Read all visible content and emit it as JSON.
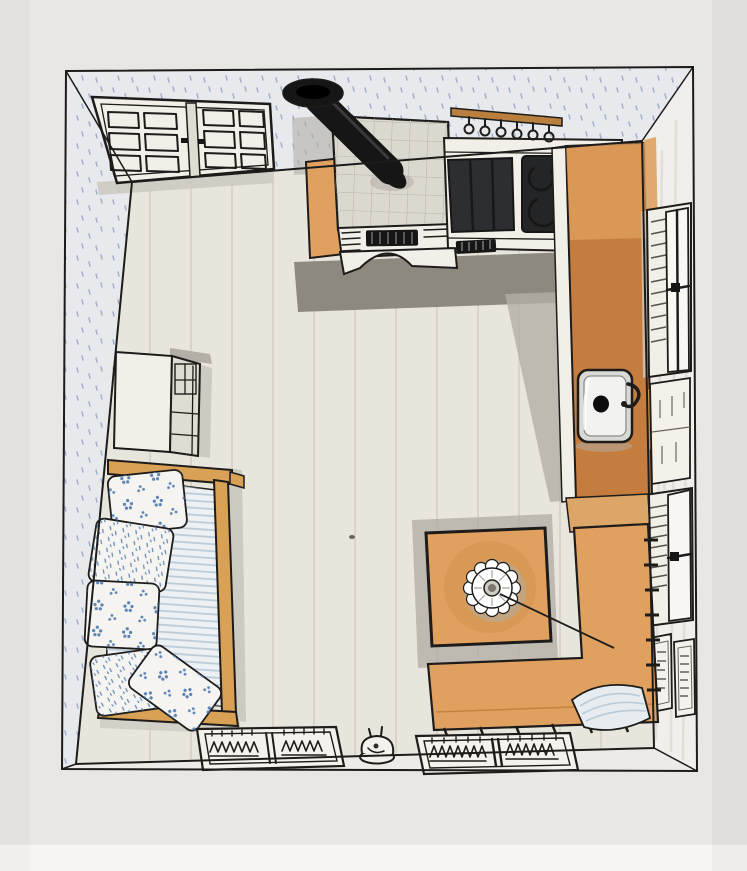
{
  "meta": {
    "title": "Hand-drawn marker sketch: bird's-eye floor plan of a farmhouse kitchen",
    "view": "top-down perspective, walls splayed outward, no visible text"
  },
  "palette": {
    "paper": "#e9e7e4",
    "paper_edge": "#f6f5f2",
    "ink": "#1d1c1a",
    "wall": "#e7e9ec",
    "wall_right": "#f0efeb",
    "wall_bottom": "#edebe7",
    "speckle": "#7189b4",
    "floor": "#e8e5dd",
    "plank": "#d5d0c3",
    "shadow_dark": "#8e897f",
    "shadow_mid": "#b3afa6",
    "shadow_soft": "#cdcac2",
    "orange": "#e0a160",
    "orange_deep": "#c57c3f",
    "wood": "#d8a155",
    "wood_deep": "#b97f3f",
    "stove_top": "#dbd8cf",
    "grid_line": "#b7b3a7",
    "panel_dark": "#2c2e31",
    "black": "#161616",
    "white_obj": "#f1efe7",
    "white_shade": "#dfdcd2",
    "metal": "#d9d9d6",
    "metal_hi": "#f2f2f0",
    "mattress": "#eef1f3",
    "stripe": "#b5c8d6",
    "blue": "#4a76ad",
    "paper_sheet": "#e6ecf0",
    "sheet_line": "#b9cbd8"
  },
  "scene": {
    "objects": [
      {
        "id": "room",
        "label": "square room seen from above"
      },
      {
        "id": "double-door",
        "label": "paneled double door on top wall"
      },
      {
        "id": "wood-stove",
        "label": "wood stove with tiled top"
      },
      {
        "id": "chimney-pipe",
        "label": "black angled stove pipe with wall flange"
      },
      {
        "id": "utensil-rail",
        "label": "wall rail with hanging utensils"
      },
      {
        "id": "worktop",
        "label": "counter with dark worktop panels"
      },
      {
        "id": "cooktop",
        "label": "dark hob with two burner rings"
      },
      {
        "id": "right-counter",
        "label": "orange counter along right wall"
      },
      {
        "id": "sink",
        "label": "square metal sink with faucet"
      },
      {
        "id": "window-upper",
        "label": "curtained window upper right wall"
      },
      {
        "id": "shuttered-panel",
        "label": "plain panel mid right wall"
      },
      {
        "id": "window-lower",
        "label": "curtained window lower right wall"
      },
      {
        "id": "wall-art",
        "label": "two small framed prints"
      },
      {
        "id": "cupboard",
        "label": "white cupboard against left wall"
      },
      {
        "id": "daybed",
        "label": "wooden bench with striped mattress"
      },
      {
        "id": "cushions",
        "label": "five blue patterned cushions"
      },
      {
        "id": "table",
        "label": "square orange table"
      },
      {
        "id": "pendant-lamp",
        "label": "scalloped lamp with cord"
      },
      {
        "id": "corner-bench",
        "label": "L-shaped corner bench"
      },
      {
        "id": "papers",
        "label": "loose papers on bench"
      },
      {
        "id": "rug-left",
        "label": "woven rag rug left"
      },
      {
        "id": "rug-right",
        "label": "woven rag rug right"
      },
      {
        "id": "small-jug",
        "label": "small jug on floor"
      },
      {
        "id": "floor",
        "label": "plank floor"
      },
      {
        "id": "walls",
        "label": "speckled wallpaper walls"
      }
    ]
  }
}
